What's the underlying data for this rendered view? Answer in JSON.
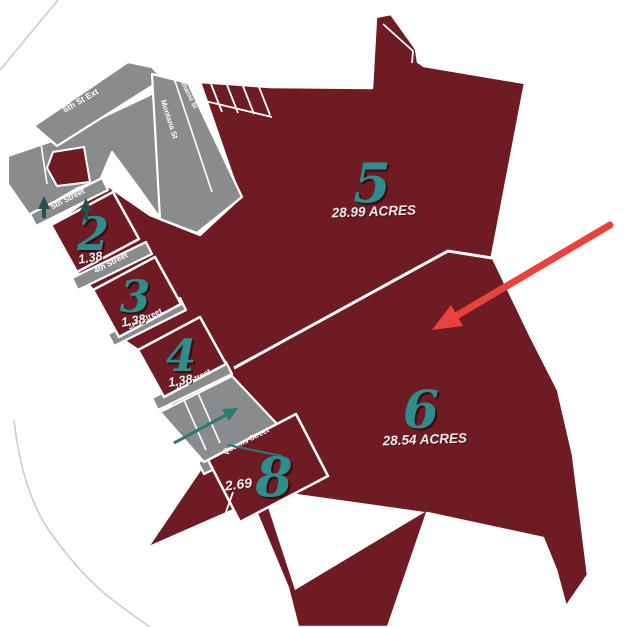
{
  "title": "subdivision-plat-map",
  "colors": {
    "parcel_fill": "#6e1b24",
    "street_fill": "#8a8b8d",
    "parcel_number_teal": "#2f8e8c",
    "annotation_arrow_red": "#e8423d",
    "border_white": "#ffffff",
    "faint_boundary_gray": "#c9ccd2",
    "small_arrow_teal": "#2d7a70"
  },
  "parcels": {
    "p2": {
      "number": "2",
      "area": "1.38"
    },
    "p3": {
      "number": "3",
      "area": "1.38"
    },
    "p4": {
      "number": "4",
      "area": "1.38"
    },
    "p5": {
      "number": "5",
      "area": "28.99 ACRES"
    },
    "p6": {
      "number": "6",
      "area": "28.54 ACRES"
    },
    "p8": {
      "number": "8",
      "area": "2.69"
    }
  },
  "streets": {
    "sixth_ext": "6th St Ext",
    "treharne": "Treharne St",
    "montana": "Montana St",
    "fifth": "5th Street",
    "fourth": "4th Street",
    "third": "3rd Street",
    "second": "2nd Street",
    "queens": "Queens Street"
  }
}
